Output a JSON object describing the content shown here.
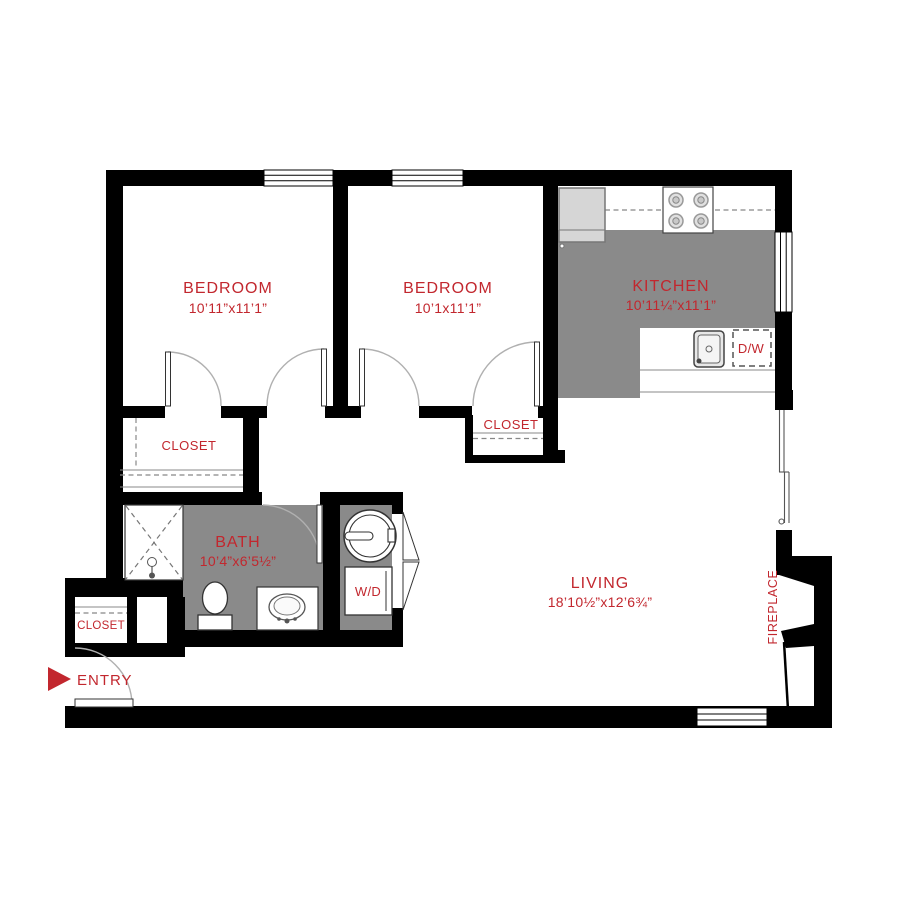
{
  "palette": {
    "wall_black": "#000000",
    "floor_gray": "#8a8a8a",
    "label_red": "#c2272e",
    "appliance_gray": "#d6d6d6",
    "background": "#ffffff"
  },
  "rooms": {
    "bedroom_1": {
      "label": "BEDROOM",
      "dims": "10’11”x11’1”"
    },
    "bedroom_2": {
      "label": "BEDROOM",
      "dims": "10’1x11’1”"
    },
    "kitchen": {
      "label": "KITCHEN",
      "dims": "10’11¼”x11’1”"
    },
    "bath": {
      "label": "BATH",
      "dims": "10’4”x6’5½”"
    },
    "living": {
      "label": "LIVING",
      "dims": "18’10½”x12’6¾”"
    }
  },
  "labels": {
    "closet_bedroom_1": "CLOSET",
    "closet_bedroom_2": "CLOSET",
    "closet_entry": "CLOSET",
    "washer_dryer": "W/D",
    "dishwasher": "D/W",
    "entry": "ENTRY",
    "fireplace": "FIREPLACE"
  }
}
